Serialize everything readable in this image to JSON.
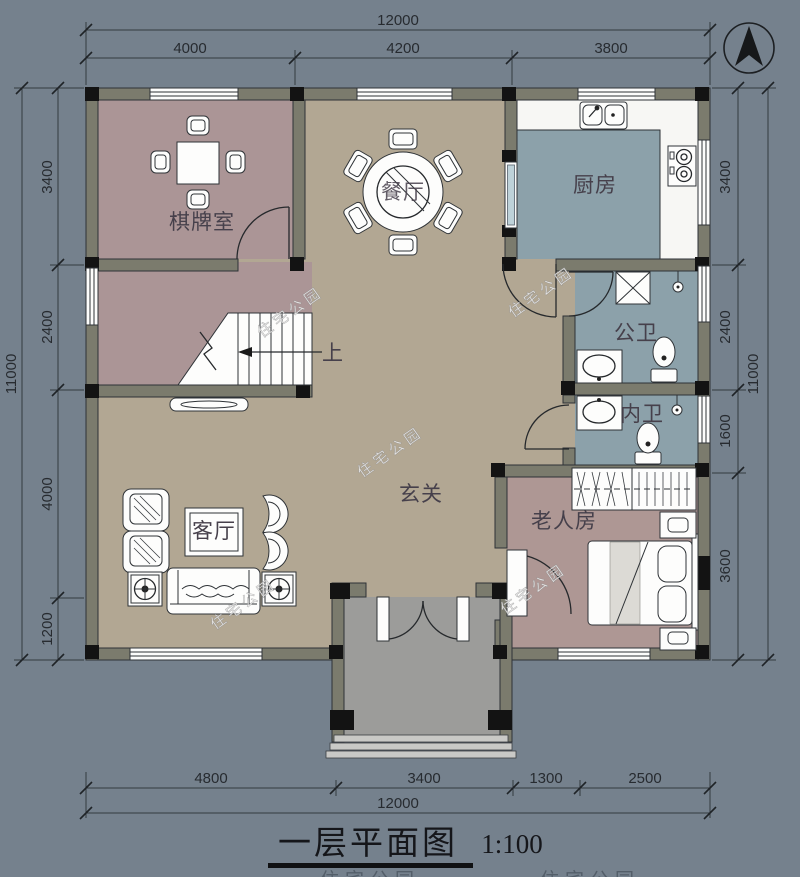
{
  "page": {
    "background": "#75818d"
  },
  "title": {
    "text": "一层平面图",
    "scale": "1:100"
  },
  "watermark": {
    "text": "住宅公园"
  },
  "icons": {
    "compass": "north-arrow"
  },
  "rooms": {
    "chess": {
      "label": "棋牌室"
    },
    "dining": {
      "label": "餐厅"
    },
    "kitchen": {
      "label": "厨房"
    },
    "public_bath": {
      "label": "公卫"
    },
    "inner_bath": {
      "label": "内卫"
    },
    "foyer": {
      "label": "玄关"
    },
    "living": {
      "label": "客厅"
    },
    "elder": {
      "label": "老人房"
    },
    "stairs": {
      "label": "上"
    }
  },
  "dimensions": {
    "top": {
      "total": "12000",
      "segments": [
        "4000",
        "4200",
        "3800"
      ]
    },
    "bottom": {
      "total": "12000",
      "segments": [
        "4800",
        "3400",
        "1300",
        "2500"
      ]
    },
    "left": {
      "total": "11000",
      "segments": [
        "3400",
        "2400",
        "4000",
        "1200"
      ]
    },
    "right": {
      "total": "11000",
      "segments": [
        "3400",
        "2400",
        "1600",
        "3600"
      ]
    }
  },
  "colors": {
    "background": "#75818d",
    "floor_tan": "#b2a793",
    "floor_mauve": "#ab9596",
    "floor_blue": "#8ca1aa",
    "floor_porch": "#9c9c9a",
    "wall": "#7b7b6d",
    "column": "#131313"
  }
}
